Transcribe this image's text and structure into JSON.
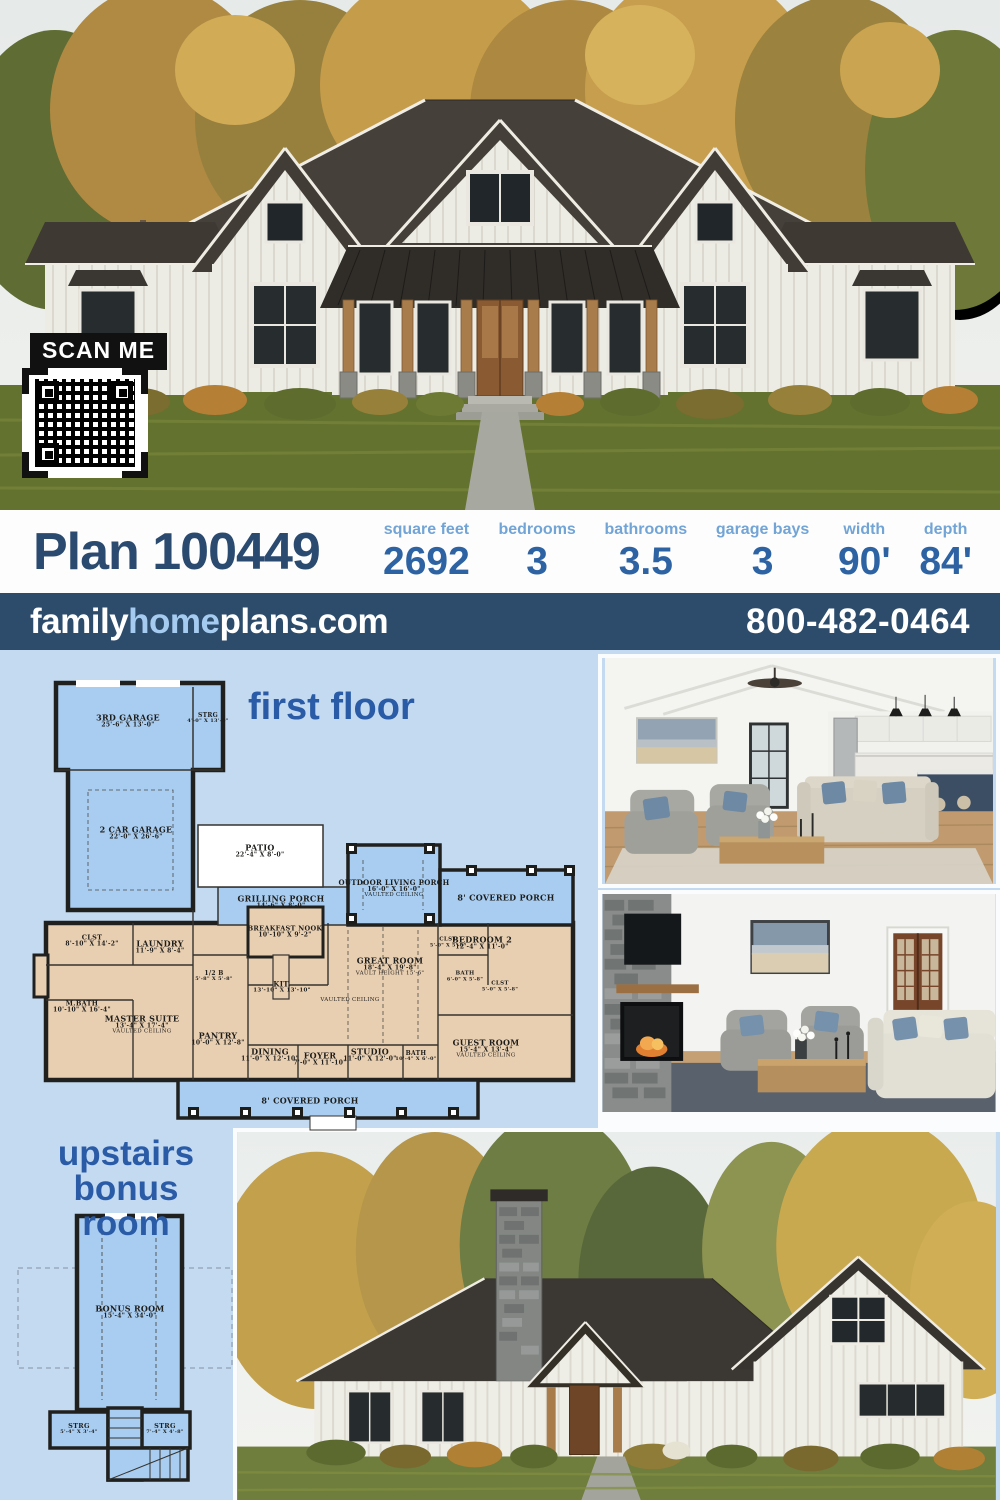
{
  "hero": {
    "scan_label": "SCAN ME"
  },
  "header": {
    "plan_title": "Plan 100449",
    "stats": [
      {
        "label": "square feet",
        "value": "2692"
      },
      {
        "label": "bedrooms",
        "value": "3"
      },
      {
        "label": "bathrooms",
        "value": "3.5"
      },
      {
        "label": "garage bays",
        "value": "3"
      },
      {
        "label": "width",
        "value": "90'"
      },
      {
        "label": "depth",
        "value": "84'"
      }
    ]
  },
  "brandbar": {
    "family": "family",
    "home": "home",
    "plans": "plans.com",
    "phone": "800-482-0464"
  },
  "first_floor": {
    "title": "first floor",
    "rooms": [
      {
        "name": "3RD GARAGE",
        "dims": "25'-6\" X 13'-0\""
      },
      {
        "name": "STRG",
        "dims": "4'-0\" X 13'-0\""
      },
      {
        "name": "2 CAR GARAGE",
        "dims": "22'-0\" X 26'-6\""
      },
      {
        "name": "PATIO",
        "dims": "22'-4\" X 8'-0\""
      },
      {
        "name": "GRILLING PORCH",
        "dims": "14'-6\" X 8'-0\""
      },
      {
        "name": "OUTDOOR LIVING PORCH",
        "dims": "16'-0\" X 16'-0\"",
        "note": "VAULTED CEILING"
      },
      {
        "name": "8' COVERED PORCH"
      },
      {
        "name": "BREAKFAST NOOK",
        "dims": "10'-10\" X 9'-2\""
      },
      {
        "name": "CLST",
        "dims": "8'-10\" X 14'-2\""
      },
      {
        "name": "LAUNDRY",
        "dims": "11'-9\" X 8'-4\""
      },
      {
        "name": "M.BATH",
        "dims": "10'-10\" X 16'-4\""
      },
      {
        "name": "MASTER SUITE",
        "dims": "13'-4\" X 17'-4\"",
        "note": "VAULTED CEILING"
      },
      {
        "name": "PANTRY",
        "dims": "10'-0\" X 12'-8\""
      },
      {
        "name": "1/2 B",
        "dims": "5'-8\" X 5'-8\""
      },
      {
        "name": "KIT.",
        "dims": "13'-10\" X 13'-10\""
      },
      {
        "name": "GREAT ROOM",
        "dims": "18'-4\" X 19'-8\"",
        "note": "VAULT HEIGHT 15'-6\""
      },
      {
        "name": "VAULTED CEILING"
      },
      {
        "name": "DINING",
        "dims": "11'-0\" X 12'-10\""
      },
      {
        "name": "FOYER",
        "dims": "7'-0\" X 11'-10\""
      },
      {
        "name": "STUDIO",
        "dims": "11'-0\" X 12'-0\""
      },
      {
        "name": "BATH",
        "dims": "10'-4\" X 6'-0\""
      },
      {
        "name": "BEDROOM 2",
        "dims": "12'-4\" X 11'-0\""
      },
      {
        "name": "CLST",
        "dims": "5'-0\" X 5'-8\""
      },
      {
        "name": "BATH",
        "dims": "6'-0\" X 5'-8\""
      },
      {
        "name": "CLST",
        "dims": "5'-0\" X 5'-8\""
      },
      {
        "name": "GUEST ROOM",
        "dims": "15'-4\" X 13'-4\"",
        "note": "VAULTED CEILING"
      },
      {
        "name": "8' COVERED PORCH"
      }
    ]
  },
  "bonus": {
    "title_line1": "upstairs",
    "title_line2": "bonus room",
    "rooms": [
      {
        "name": "BONUS ROOM",
        "dims": "15'-4\" X 34'-0\""
      },
      {
        "name": "STRG",
        "dims": "5'-4\" X 3'-4\""
      },
      {
        "name": "STRG",
        "dims": "7'-4\" X 4'-8\""
      }
    ]
  },
  "colors": {
    "accent_navy": "#2b4a70",
    "stat_value_blue": "#2d63a3",
    "stat_label_blue": "#72a4d6",
    "bar_background": "#2d4c6c",
    "home_light_blue": "#a6cbf0",
    "panel_background": "#c4daf0",
    "plan_porch_blue": "#a9cdf0",
    "plan_room_tan": "#e9cfb1",
    "plan_title_blue": "#2a5ba7"
  }
}
